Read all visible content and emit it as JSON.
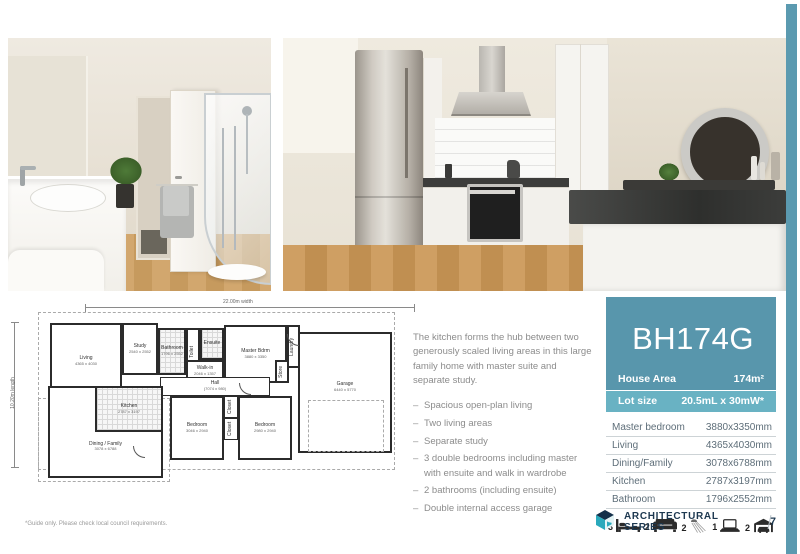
{
  "model": {
    "code": "BH174G",
    "house_area_label": "House Area",
    "house_area_value": "174m²",
    "lot_size_label": "Lot size",
    "lot_size_value": "20.5mL x 30mW*"
  },
  "dimensions_table": {
    "rows": [
      {
        "label": "Master bedroom",
        "value": "3880x3350mm"
      },
      {
        "label": "Living",
        "value": "4365x4030mm"
      },
      {
        "label": "Dining/Family",
        "value": "3078x6788mm"
      },
      {
        "label": "Kitchen",
        "value": "2787x3197mm"
      },
      {
        "label": "Bathroom",
        "value": "1796x2552mm"
      }
    ]
  },
  "feature_icons": [
    {
      "count": "3",
      "icon": "bed-icon"
    },
    {
      "count": "2",
      "icon": "sofa-icon"
    },
    {
      "count": "2",
      "icon": "shower-icon"
    },
    {
      "count": "1",
      "icon": "study-icon"
    },
    {
      "count": "2",
      "icon": "garage-icon"
    }
  ],
  "description": {
    "intro": "The kitchen forms the hub between two generously scaled living areas in this large family home with master suite and separate study.",
    "bullets": [
      "Spacious open-plan living",
      "Two living areas",
      "Separate study",
      "3 double bedrooms including master with ensuite and walk in wardrobe",
      "2 bathrooms (including ensuite)",
      "Double internal access garage"
    ]
  },
  "floorplan": {
    "width_label": "22.00m width",
    "length_label": "10.20m length",
    "rooms": [
      {
        "name": "Living",
        "dims": "4365 x 4030"
      },
      {
        "name": "Study",
        "dims": "2540 x 2552"
      },
      {
        "name": "Bathroom",
        "dims": "1796 x 2552"
      },
      {
        "name": "Toilet"
      },
      {
        "name": "Ensuite"
      },
      {
        "name": "Walk-in",
        "dims": "2046 x 1357"
      },
      {
        "name": "Master Bdrm",
        "dims": "3880 x 3350"
      },
      {
        "name": "Laundry"
      },
      {
        "name": "Store"
      },
      {
        "name": "Hall",
        "dims": "(7074 x 980)"
      },
      {
        "name": "Garage",
        "dims": "6440 x 5770"
      },
      {
        "name": "Bedroom",
        "dims": "3046 x 2940"
      },
      {
        "name": "Bedroom",
        "dims": "2980 x 2940"
      },
      {
        "name": "Closet"
      },
      {
        "name": "Closet"
      },
      {
        "name": "Linen"
      },
      {
        "name": "Entry"
      },
      {
        "name": "Kitchen",
        "dims": "2787 x 3197"
      },
      {
        "name": "Dining / Family",
        "dims": "3078 x 6788"
      }
    ]
  },
  "footer": {
    "brand": "ARCHITECTURAL SERIES",
    "page_number": "7"
  },
  "footnote": "*Guide only. Please check local council requirements.",
  "colors": {
    "teal": "#5896ac",
    "teal_light": "#69b2c3",
    "navy": "#1d3850",
    "table_text": "#5e6e79",
    "body_text": "#8c8c8c"
  }
}
